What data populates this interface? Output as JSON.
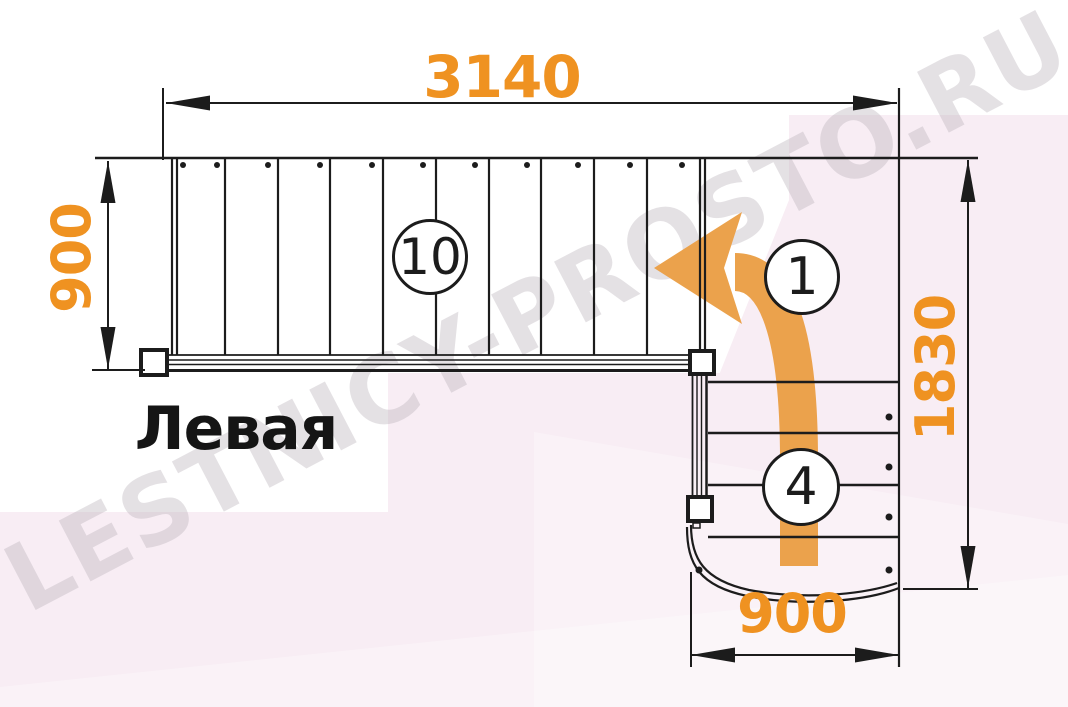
{
  "diagram": {
    "title": "Левая",
    "watermark": "LESTNICY-PROSTO.RU",
    "dimensions": {
      "top_width": "3140",
      "left_depth": "900",
      "right_height": "1830",
      "bottom_width": "900"
    },
    "step_labels": {
      "upper_flight_steps": "10",
      "first_step": "1",
      "lower_flight_steps": "4"
    },
    "colors": {
      "dimension_text": "#ef9221",
      "direction_arrow": "#eba24c",
      "drawing_line": "#1c1c1c",
      "watermark_pink": "#f8edf4",
      "watermark_gray": "#bdb6bd"
    }
  }
}
